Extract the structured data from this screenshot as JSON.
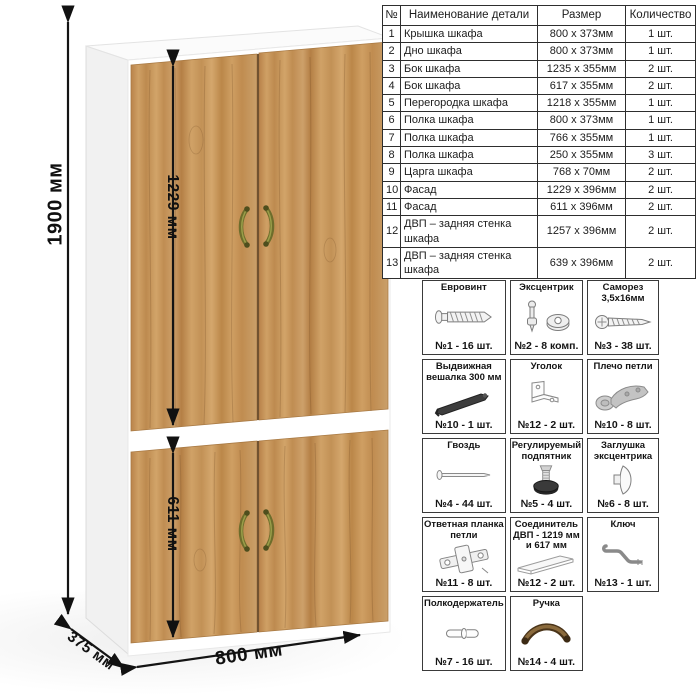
{
  "dimensions": {
    "height": "1900 мм",
    "upper_door": "1229 мм",
    "lower_door": "611 мм",
    "width": "800 мм",
    "depth": "375 мм"
  },
  "parts_table": {
    "headers": [
      "№",
      "Наименование детали",
      "Размер",
      "Количество"
    ],
    "rows": [
      [
        "1",
        "Крышка шкафа",
        "800 х 373мм",
        "1 шт."
      ],
      [
        "2",
        "Дно шкафа",
        "800 х 373мм",
        "1 шт."
      ],
      [
        "3",
        "Бок шкафа",
        "1235 х 355мм",
        "2 шт."
      ],
      [
        "4",
        "Бок шкафа",
        "617 х 355мм",
        "2 шт."
      ],
      [
        "5",
        "Перегородка шкафа",
        "1218 х 355мм",
        "1 шт."
      ],
      [
        "6",
        "Полка шкафа",
        "800 х 373мм",
        "1 шт."
      ],
      [
        "7",
        "Полка шкафа",
        "766 х 355мм",
        "1 шт."
      ],
      [
        "8",
        "Полка шкафа",
        "250 х 355мм",
        "3 шт."
      ],
      [
        "9",
        "Царга шкафа",
        "768 х 70мм",
        "2 шт."
      ],
      [
        "10",
        "Фасад",
        "1229 х 396мм",
        "2 шт."
      ],
      [
        "11",
        "Фасад",
        "611 х 396мм",
        "2 шт."
      ],
      [
        "12",
        "ДВП – задняя стенка шкафа",
        "1257 х 396мм",
        "2 шт."
      ],
      [
        "13",
        "ДВП – задняя стенка шкафа",
        "639 х 396мм",
        "2 шт."
      ]
    ]
  },
  "hardware": {
    "items": [
      {
        "title": "Евровинт",
        "icon": "euro-screw",
        "count": "№1 - 16 шт."
      },
      {
        "title": "Эксцентрик",
        "icon": "cam-lock",
        "count": "№2 - 8 комп."
      },
      {
        "title": "Саморез 3,5х16мм",
        "icon": "self-tapping-screw",
        "count": "№3 - 38 шт."
      },
      {
        "title": "Выдвижная вешалка 300 мм",
        "icon": "pull-out-hanger",
        "count": "№10 - 1 шт."
      },
      {
        "title": "Уголок",
        "icon": "corner-bracket",
        "count": "№12 - 2 шт."
      },
      {
        "title": "Плечо петли",
        "icon": "hinge-arm",
        "count": "№10 - 8 шт."
      },
      {
        "title": "Гвоздь",
        "icon": "nail",
        "count": "№4 - 44 шт."
      },
      {
        "title": "Регулируемый подпятник",
        "icon": "adjustable-foot",
        "count": "№5 - 4 шт."
      },
      {
        "title": "Заглушка эксцентрика",
        "icon": "cam-cover",
        "count": "№6 - 8 шт."
      },
      {
        "title": "Ответная планка петли",
        "icon": "hinge-plate",
        "count": "№11 - 8 шт."
      },
      {
        "title": "Соединитель ДВП - 1219 мм и 617 мм",
        "icon": "hdf-connector",
        "count": "№12 - 2 шт."
      },
      {
        "title": "Ключ",
        "icon": "hex-key",
        "count": "№13 - 1 шт."
      },
      {
        "title": "Полкодержатель",
        "icon": "shelf-pin",
        "count": "№7 - 16 шт."
      },
      {
        "title": "Ручка",
        "icon": "handle",
        "count": "№14 - 4 шт."
      }
    ]
  },
  "colors": {
    "wood": "#c89a5e",
    "carcass_white": "#ffffff",
    "handle_bronze": "#6d6d2b",
    "dimension_black": "#111111",
    "table_border": "#2e2e2e"
  }
}
